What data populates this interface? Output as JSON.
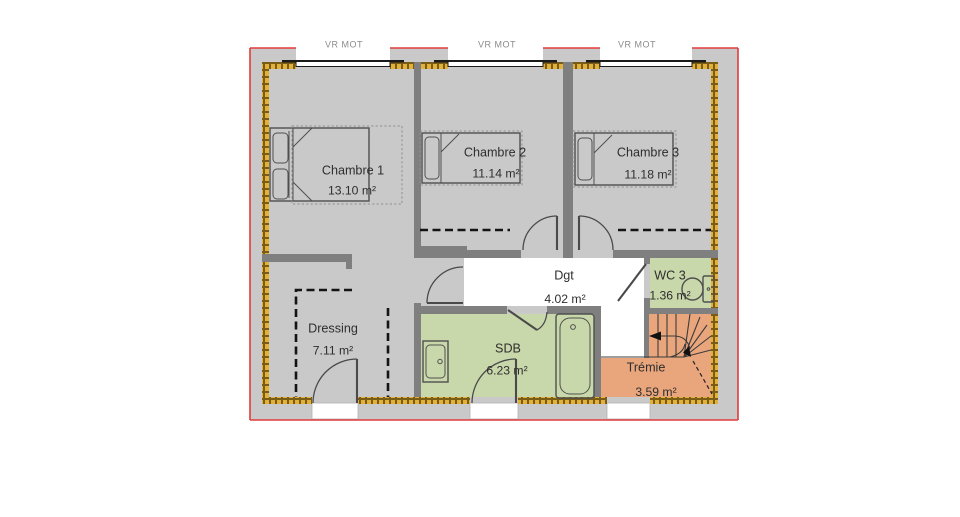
{
  "plan": {
    "shutter_labels": [
      "VR MOT",
      "VR MOT",
      "VR MOT"
    ],
    "rooms": [
      {
        "name": "Chambre 1",
        "area": "13.10 m²"
      },
      {
        "name": "Chambre 2",
        "area": "11.14 m²"
      },
      {
        "name": "Chambre 3",
        "area": "11.18 m²"
      },
      {
        "name": "Dgt",
        "area": "4.02 m²"
      },
      {
        "name": "WC 3",
        "area": "1.36 m²"
      },
      {
        "name": "Dressing",
        "area": "7.11 m²"
      },
      {
        "name": "SDB",
        "area": "6.23 m²"
      },
      {
        "name": "Trémie",
        "area": "3.59 m²"
      }
    ],
    "colors": {
      "floor_gray": "#c9c9c9",
      "wall_gray": "#7f7f7f",
      "room_green": "#c9d8ab",
      "room_orange": "#e9a67c",
      "hall_white": "#ffffff",
      "outline_red": "#e23b3b",
      "insulation_gold": "#e2b13c",
      "insulation_dark": "#7a5c14",
      "door_stroke": "#4a4a4a"
    }
  }
}
